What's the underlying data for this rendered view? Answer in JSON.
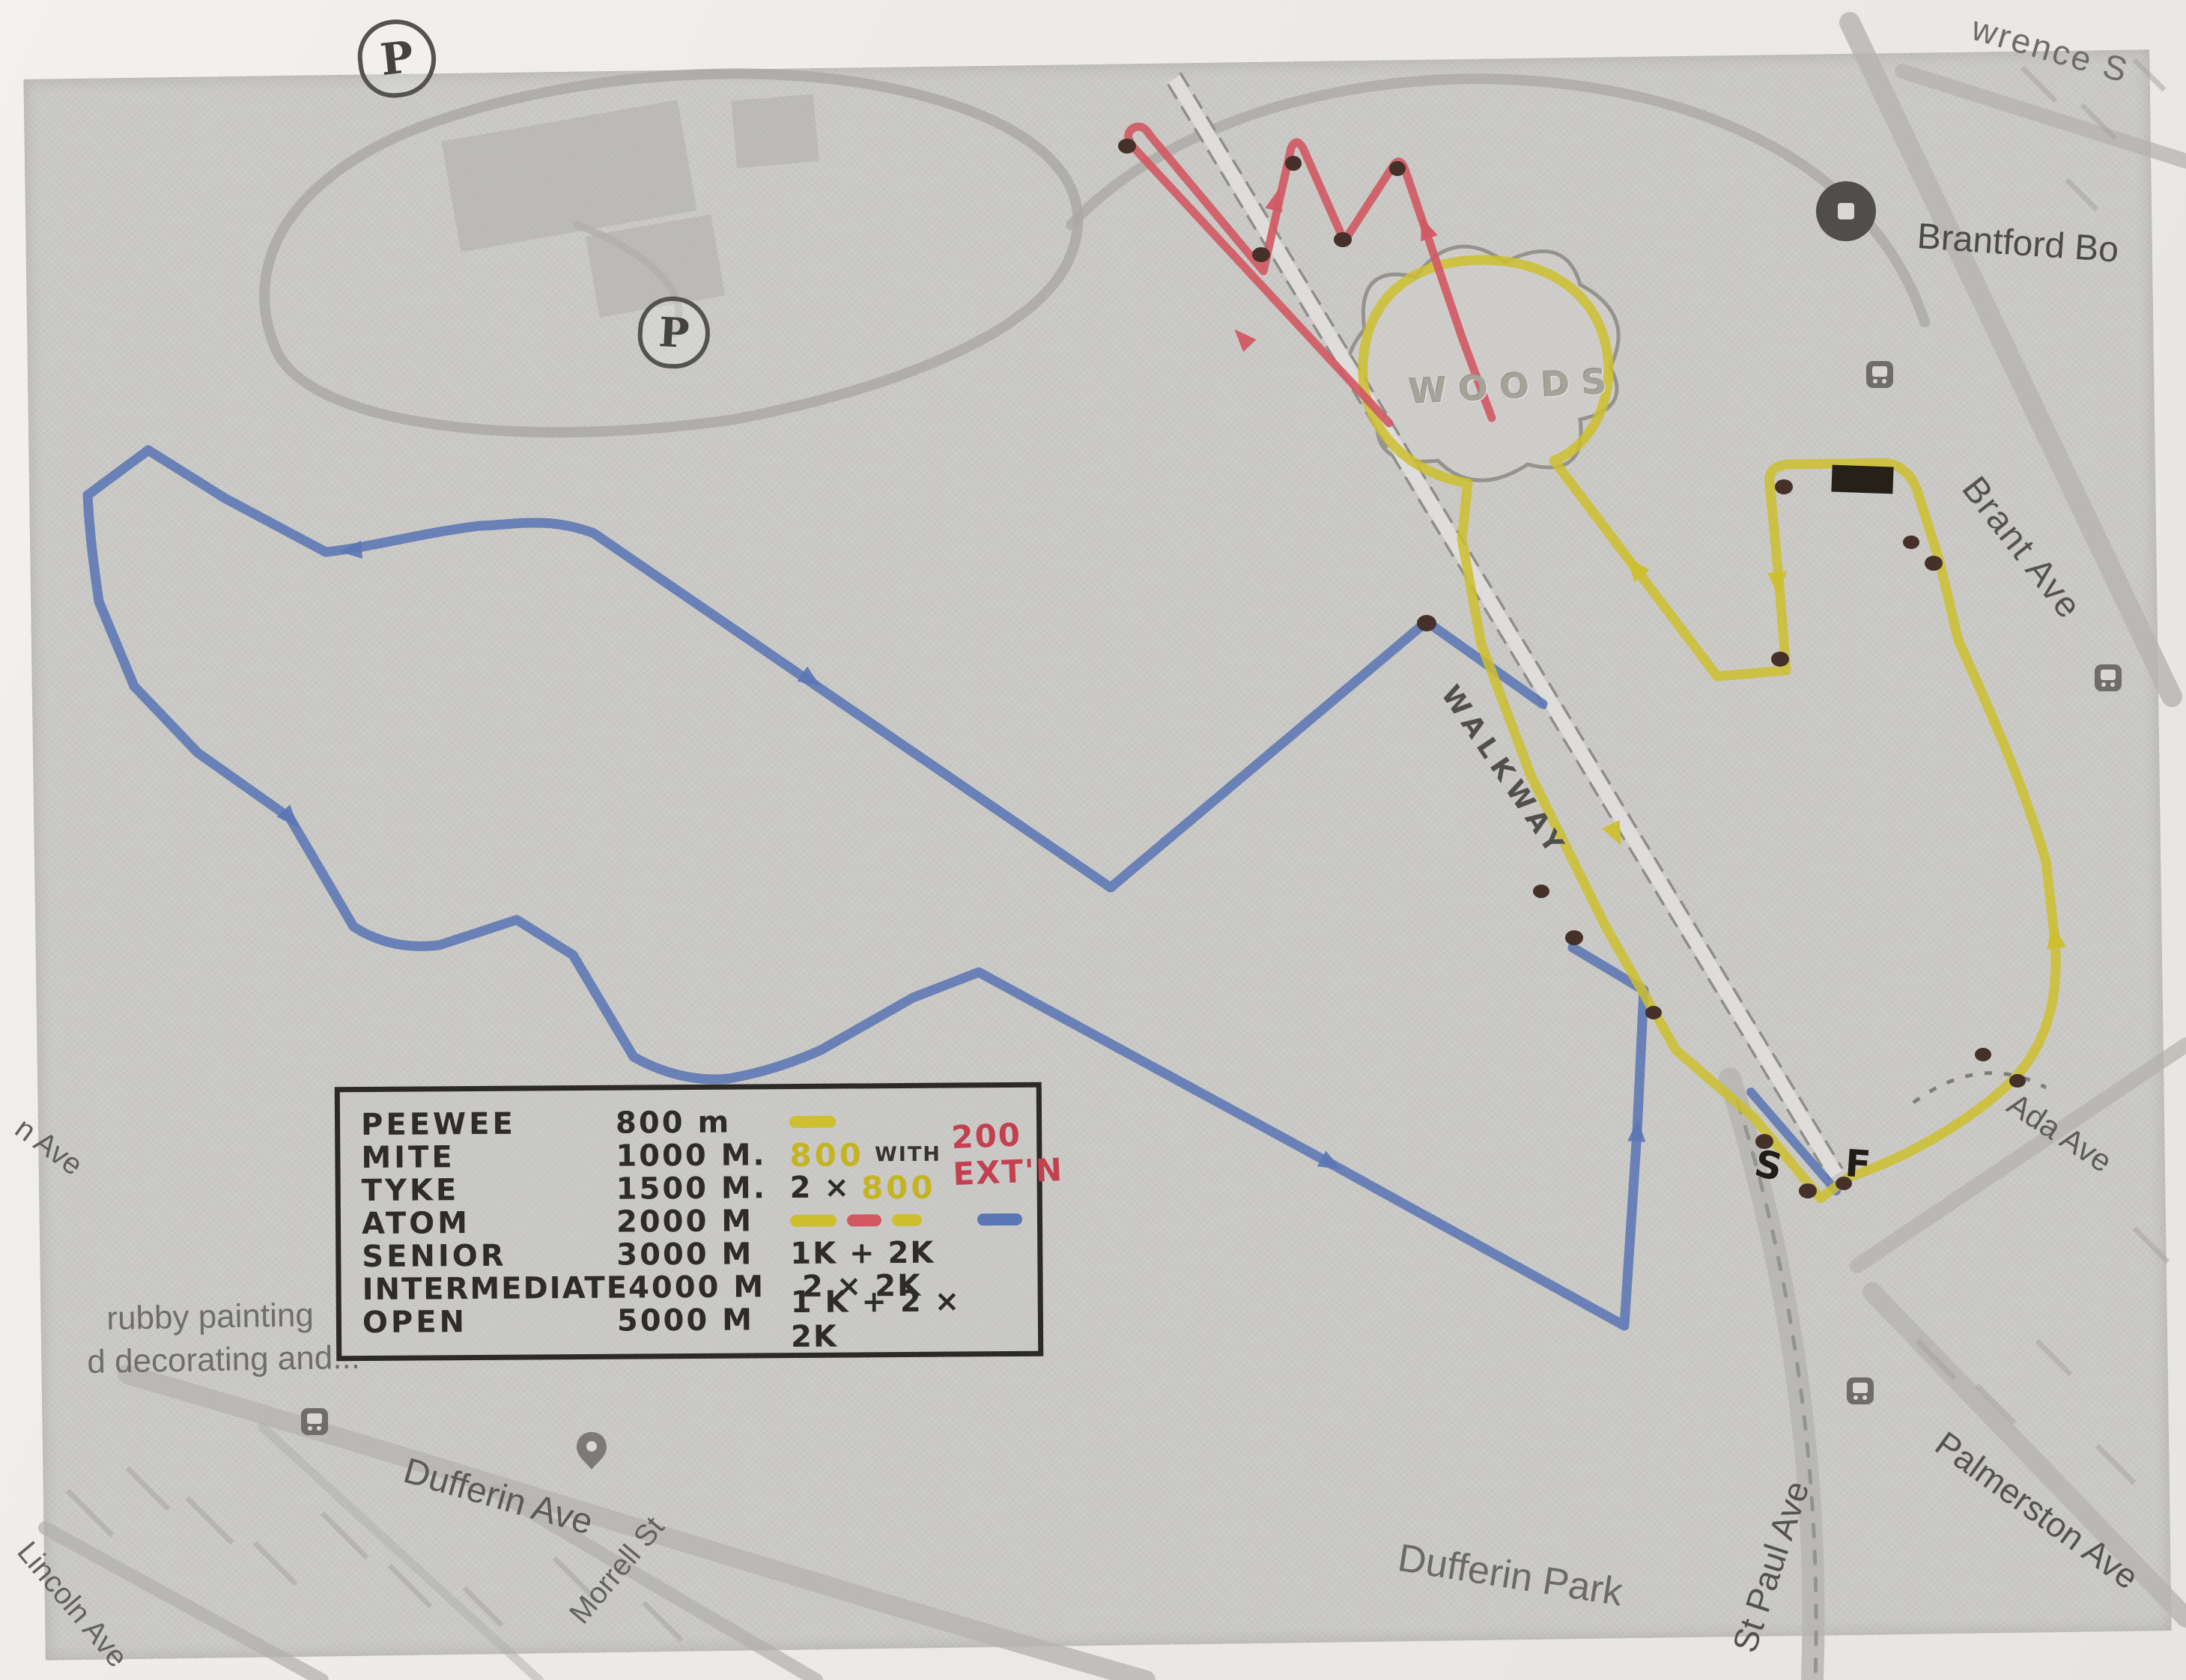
{
  "map": {
    "park_name": "Dufferin Park",
    "labels": {
      "lawrence_partial": "wrence S",
      "brantford_poi": "Brantford Bo",
      "brant_ave": "Brant Ave",
      "ada_ave": "Ada Ave",
      "palmerston_ave": "Palmerston Ave",
      "st_paul_ave": "St Paul Ave",
      "dufferin_park": "Dufferin Park",
      "dufferin_ave": "Dufferin Ave",
      "lincoln_ave": "Lincoln Ave",
      "morrell_st": "Morrell St",
      "partial_ave": "n Ave",
      "painting_line1": "rubby painting",
      "painting_line2": "d decorating and...",
      "woods": "WOODS",
      "walkway": "WALKWAY"
    },
    "annotations": {
      "start_letter": "S",
      "finish_letter": "F",
      "parking_letter": "P"
    },
    "colors": {
      "route_blue": "#5b76b4",
      "route_yellow": "#cdbf2e",
      "route_red": "#d25863",
      "marker_dot_brown": "#46302a",
      "map_gray": "#c9c8c5",
      "paper": "#efede9"
    }
  },
  "legend": {
    "rows": [
      {
        "name": "PEEWEE",
        "distance": "800 m",
        "note": ""
      },
      {
        "name": "MITE",
        "distance": "1000 M.",
        "note_800": "800",
        "note_mid": "WITH",
        "note_ext": "200 EXT'N"
      },
      {
        "name": "TYKE",
        "distance": "1500 M.",
        "note_prefix": "2 ×",
        "note_800": "800"
      },
      {
        "name": "ATOM",
        "distance": "2000 M",
        "note": ""
      },
      {
        "name": "SENIOR",
        "distance": "3000 M",
        "note": "1K + 2K"
      },
      {
        "name": "INTERMEDIATE",
        "distance": "4000 M",
        "note": "2 × 2K"
      },
      {
        "name": "OPEN",
        "distance": "5000 M",
        "note": "1 K + 2 × 2K"
      }
    ]
  }
}
